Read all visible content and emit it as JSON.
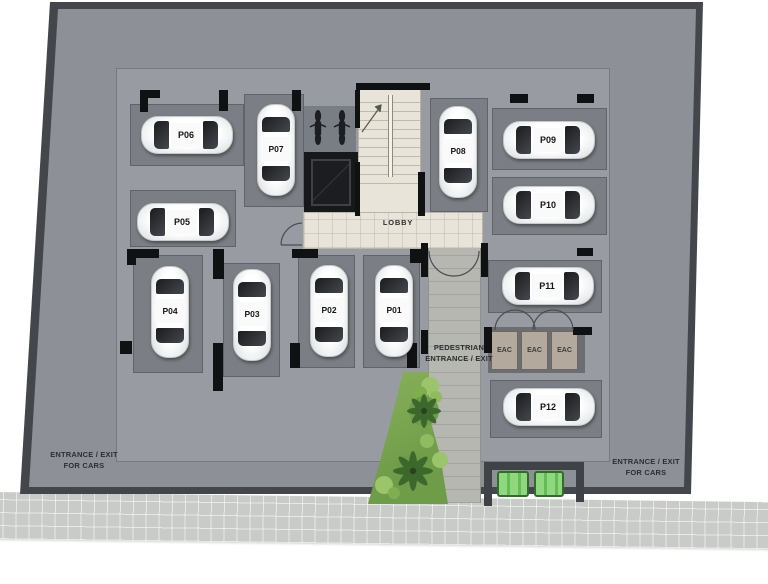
{
  "plan": {
    "lobby": {
      "label": "LOBBY"
    },
    "pedestrian_entrance": {
      "line1": "PEDESTRIAN",
      "line2": "ENTRANCE / EXIT"
    },
    "car_entrance_left": {
      "line1": "ENTRANCE / EXIT",
      "line2": "FOR CARS"
    },
    "car_entrance_right": {
      "line1": "ENTRANCE / EXIT",
      "line2": "FOR CARS"
    },
    "eac_rooms": [
      {
        "label": "EAC"
      },
      {
        "label": "EAC"
      },
      {
        "label": "EAC"
      }
    ],
    "parking_spots": {
      "p01": {
        "label": "P01"
      },
      "p02": {
        "label": "P02"
      },
      "p03": {
        "label": "P03"
      },
      "p04": {
        "label": "P04"
      },
      "p05": {
        "label": "P05"
      },
      "p06": {
        "label": "P06"
      },
      "p07": {
        "label": "P07"
      },
      "p08": {
        "label": "P08"
      },
      "p09": {
        "label": "P09"
      },
      "p10": {
        "label": "P10"
      },
      "p11": {
        "label": "P11"
      },
      "p12": {
        "label": "P12"
      }
    }
  },
  "colors": {
    "floor_outer": "#8d9197",
    "floor_inner": "#989ca2",
    "parking_bay": "#7b7f85",
    "structure_wall": "#101113",
    "stair_lobby_floor": "#e8e4d9",
    "walkway": "#b6b7b1",
    "eac_room": "#b3a99c",
    "landscape_green": "#7aa44e",
    "bench_green": "#56ab46",
    "sidewalk": "#c9cbc9",
    "car_body": "#f5f5f5",
    "text": "#2c2e31"
  }
}
